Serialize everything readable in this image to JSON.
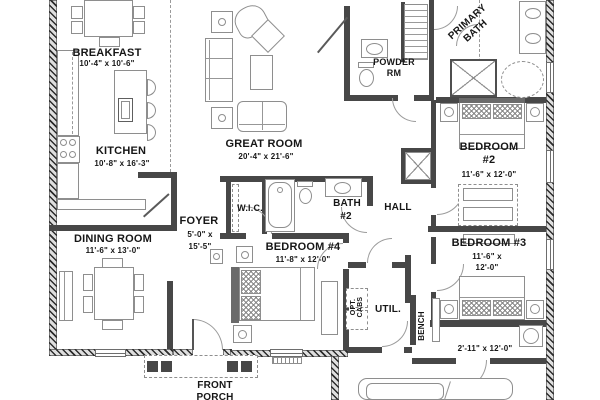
{
  "colors": {
    "wall": "#474747",
    "exterior_wall": "#adadad",
    "line": "#8e8e8e",
    "text": "#161616",
    "background": "#ffffff"
  },
  "rooms": {
    "breakfast": {
      "label": "BREAKFAST",
      "dims": "10'-4\" x 10'-6\""
    },
    "kitchen": {
      "label": "KITCHEN",
      "dims": "10'-8\" x 16'-3\""
    },
    "great_room": {
      "label": "GREAT ROOM",
      "dims": "20'-4\" x 21'-6\""
    },
    "dining_room": {
      "label": "DINING ROOM",
      "dims": "11'-6\" x 13'-0\""
    },
    "foyer": {
      "label": "FOYER",
      "dims1": "5'-0\" x",
      "dims2": "15'-5\""
    },
    "wic": {
      "label": "W.I.C."
    },
    "bath2": {
      "label1": "BATH",
      "label2": "#2"
    },
    "bedroom4": {
      "label": "BEDROOM #4",
      "dims": "11'-8\" x 12'-0\""
    },
    "powder": {
      "label1": "POWDER",
      "label2": "RM"
    },
    "primary_bath": {
      "label1": "PRIMARY",
      "label2": "BATH"
    },
    "bedroom2": {
      "label1": "BEDROOM",
      "label2": "#2",
      "dims": "11'-6\" x 12'-0\""
    },
    "bedroom3": {
      "label": "BEDROOM #3",
      "dims1": "11'-6\" x",
      "dims2": "12'-0\""
    },
    "hall": {
      "label": "HALL",
      "dims": "2'-11\" x 12'-0\""
    },
    "util": {
      "label": "UTIL."
    },
    "opt_cabs": {
      "label1": "OPT.",
      "label2": "CABS"
    },
    "bench": {
      "label": "BENCH"
    },
    "front_porch": {
      "label1": "FRONT",
      "label2": "PORCH"
    }
  }
}
